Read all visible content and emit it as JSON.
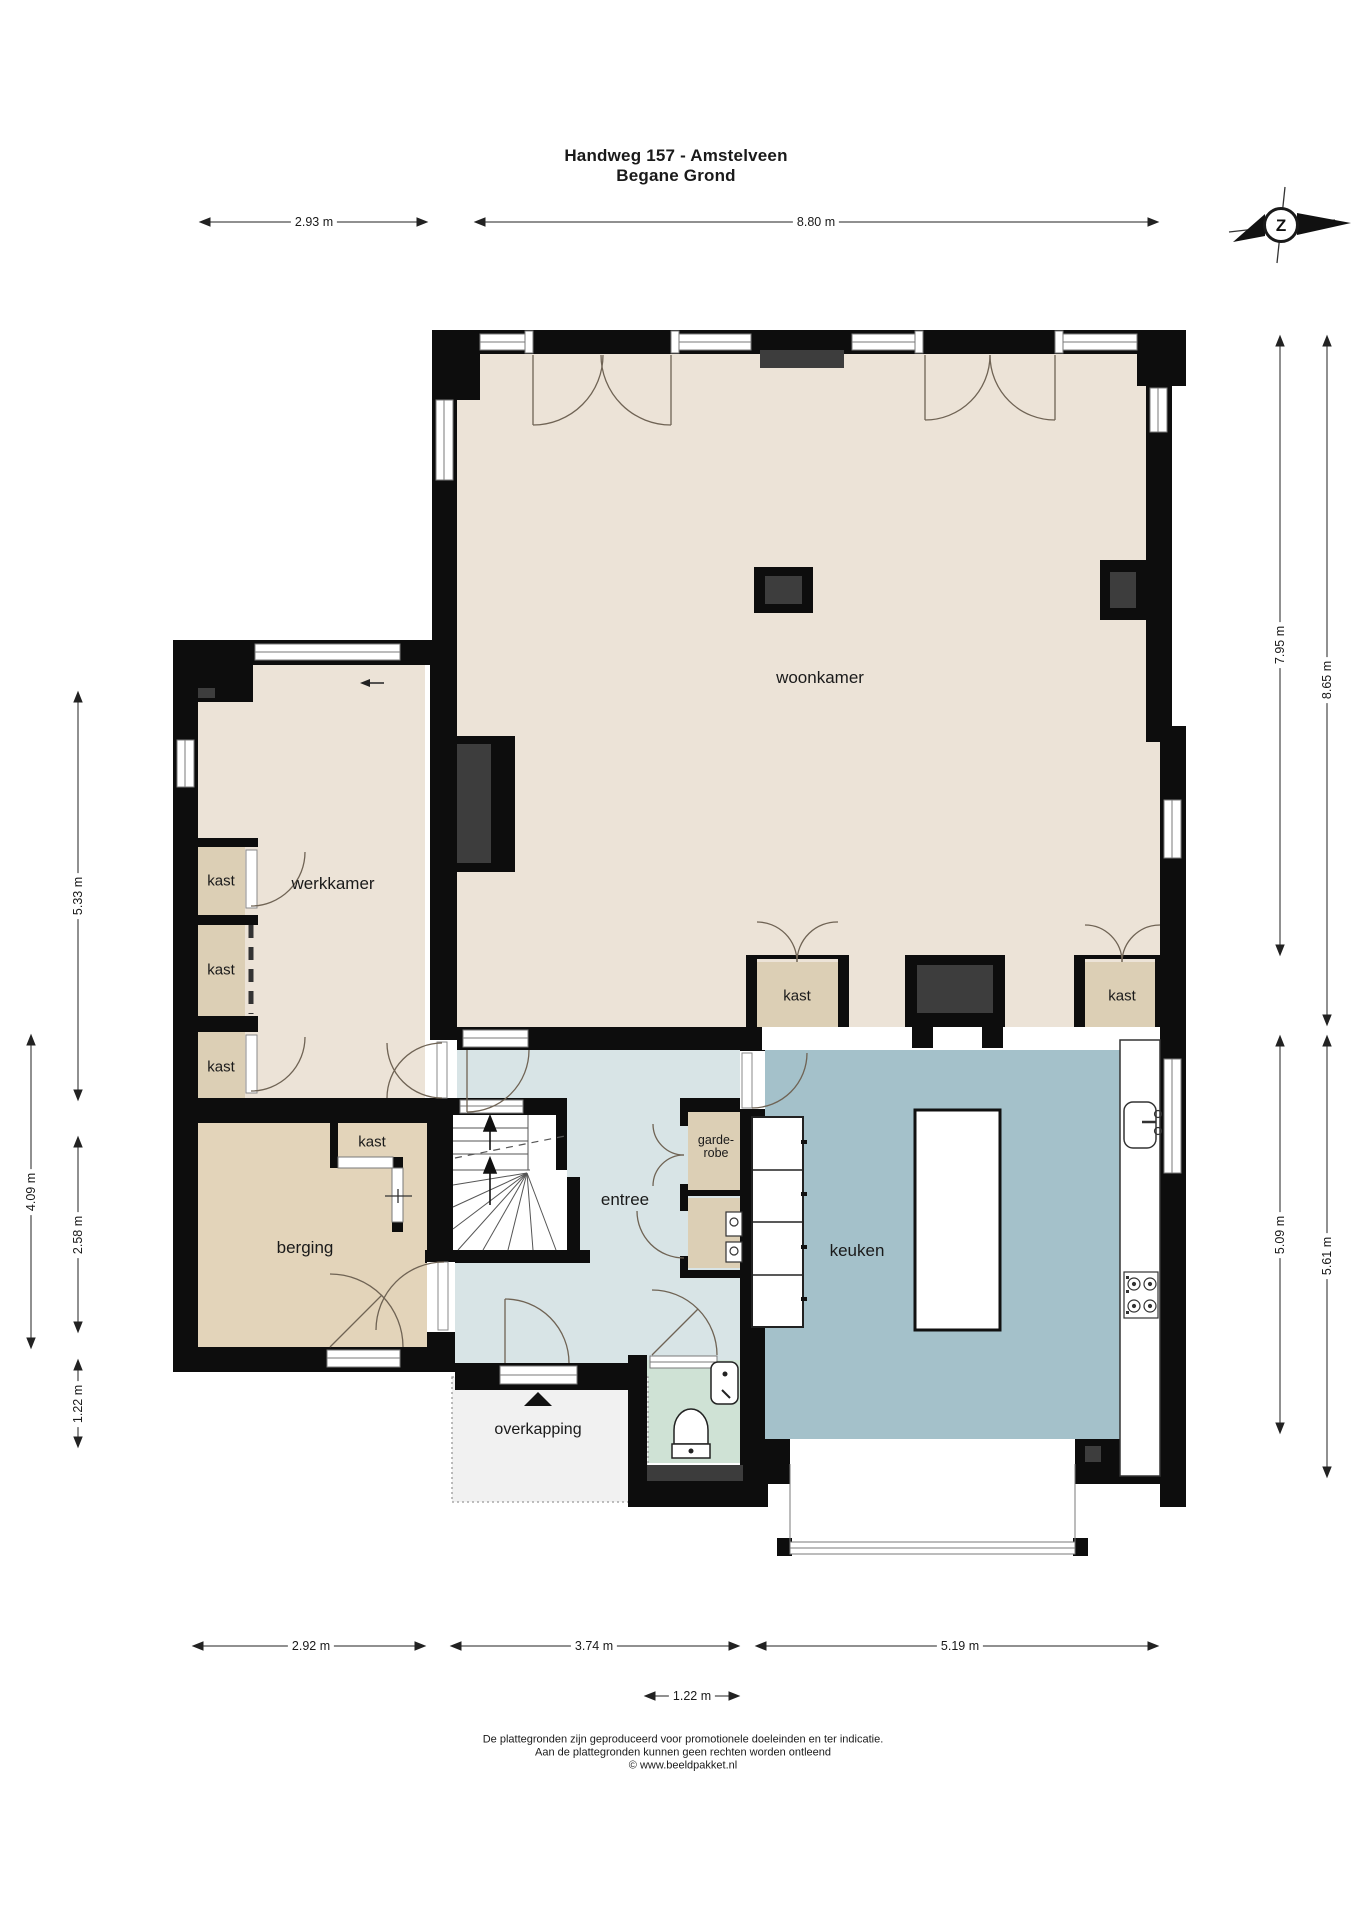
{
  "title": {
    "line1": "Handweg 157 - Amstelveen",
    "line2": "Begane Grond"
  },
  "compass": {
    "letter": "Z"
  },
  "rooms": {
    "woonkamer": "woonkamer",
    "werkkamer": "werkkamer",
    "berging": "berging",
    "entree": "entree",
    "keuken": "keuken",
    "overkapping": "overkapping",
    "kast": "kast",
    "garderobe_line1": "garde-",
    "garderobe_line2": "robe"
  },
  "dimensions": {
    "top_left": "2.93 m",
    "top_right": "8.80 m",
    "right_inner_top": "7.95 m",
    "right_outer_top": "8.65 m",
    "right_inner_bottom": "5.09 m",
    "right_outer_bottom": "5.61 m",
    "left_werkkamer": "5.33 m",
    "left_outer": "4.09 m",
    "left_berging": "2.58 m",
    "left_overkapping": "1.22 m",
    "bottom_left": "2.92 m",
    "bottom_middle": "3.74 m",
    "bottom_right": "5.19 m",
    "bottom_door": "1.22 m"
  },
  "footer": {
    "line1": "De plattegronden zijn geproduceerd voor promotionele doeleinden en ter indicatie.",
    "line2": "Aan de plattegronden kunnen geen rechten worden ontleend",
    "line3": "© www.beeldpakket.nl"
  },
  "colors": {
    "wall": "#0d0d0d",
    "floor_living": "#ece3d7",
    "floor_closet": "#dccfb5",
    "floor_storage": "#e3d4ba",
    "floor_hall": "#d8e4e6",
    "floor_kitchen": "#a4c1ca",
    "floor_wc": "#cfe2d5",
    "floor_canopy": "#f1f1f1",
    "inset_gray": "#3d3d3d",
    "arc": "#6f6354"
  }
}
